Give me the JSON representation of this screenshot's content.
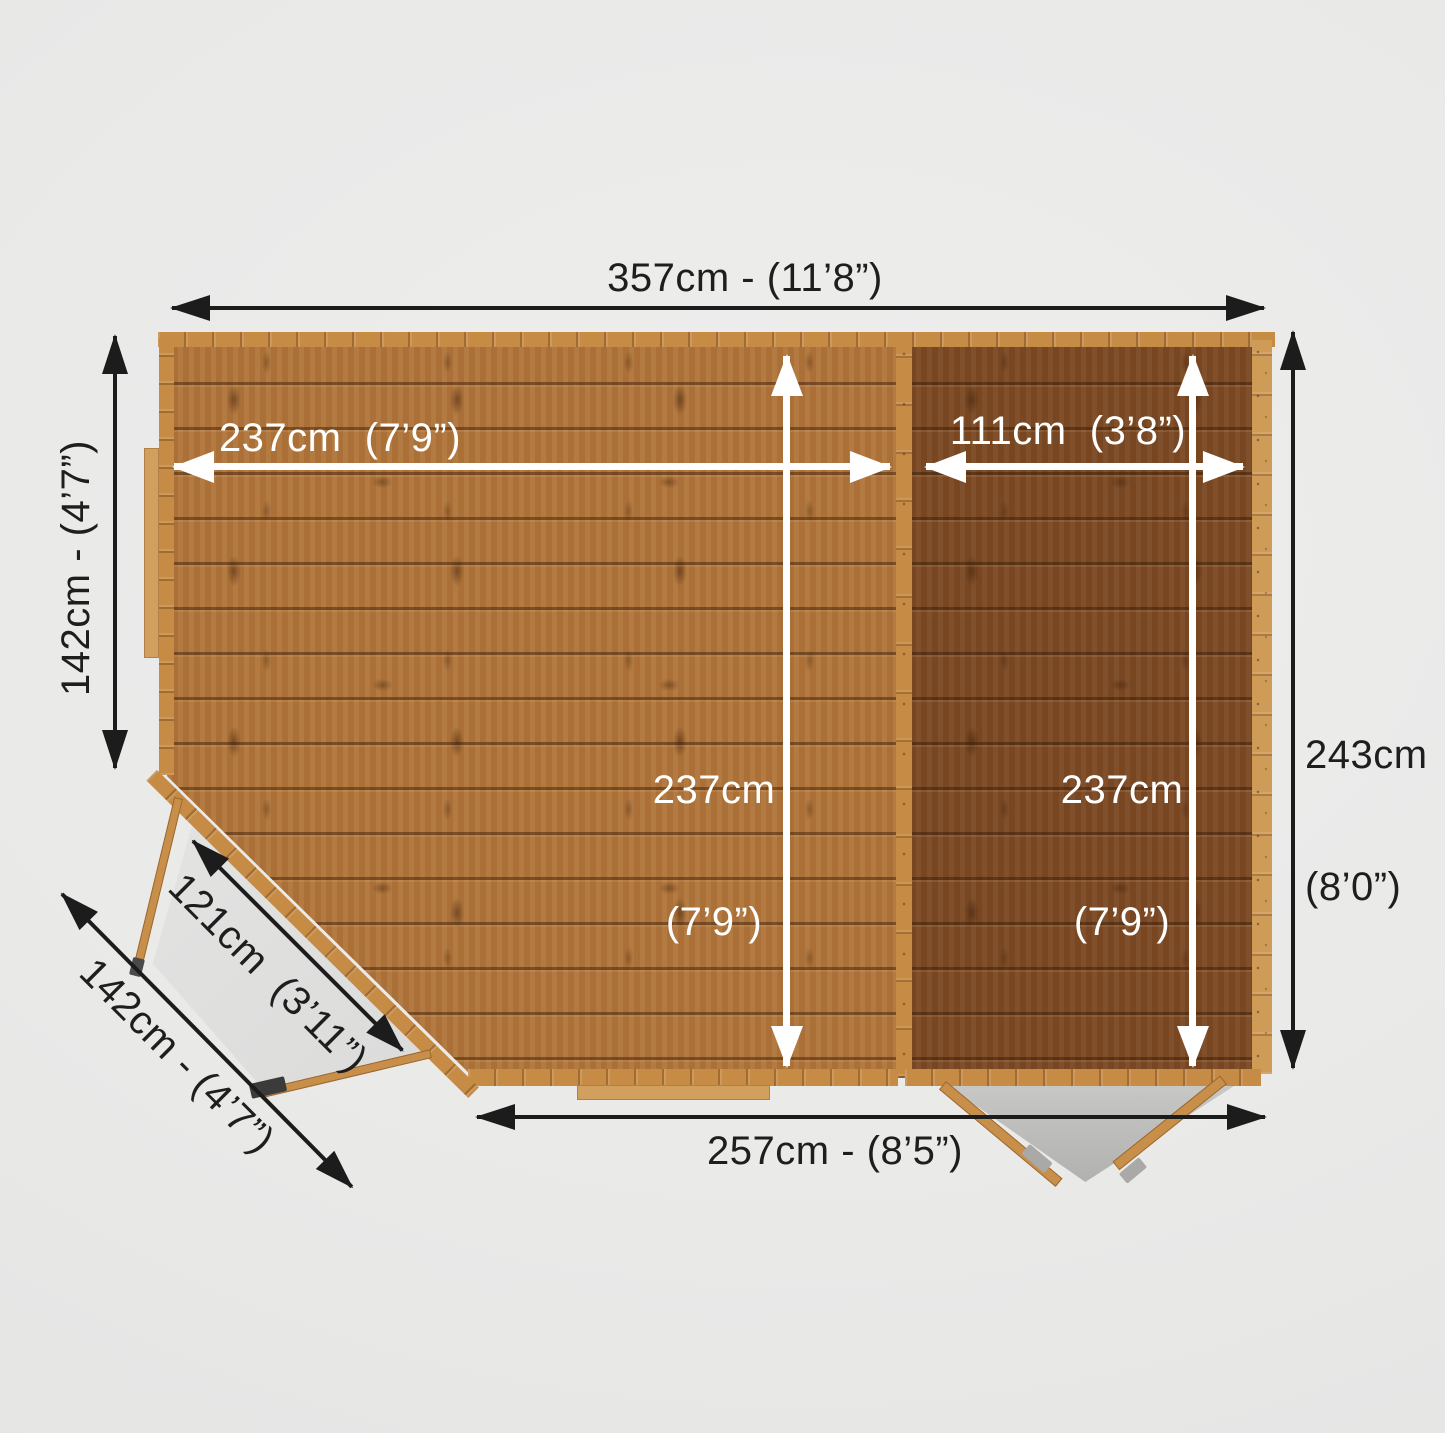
{
  "diagram": {
    "description": "Top-down floor plan of a corner summerhouse with attached side shed, annotated with metric and imperial dimensions",
    "colors": {
      "background": "#eaeae9",
      "dimension_line_dark": "#1c1c1c",
      "dimension_line_light": "#ffffff",
      "floor_main_wood": "#b0743a",
      "floor_side_wood": "#7a4822",
      "wall_wood": "#c68b45",
      "window_wood": "#d2a05e",
      "doorway_shadow": "#bcbcba",
      "label_dark": "#1e1e1e",
      "label_light": "#ffffff"
    }
  },
  "labels": {
    "top_width": "357cm - (11’8”)",
    "left_depth": "142cm - (4’7”)",
    "main_width": "237cm  (7’9”)",
    "right_width": "111cm  (3’8”)",
    "main_depth_cm": "237cm",
    "main_depth_imp": "(7’9”)",
    "right_depth_cm": "237cm",
    "right_depth_imp": "(7’9”)",
    "overall_depth_cm": "243cm",
    "overall_depth_imp": "(8’0”)",
    "bottom_width": "257cm - (8’5”)",
    "door_diagonal": "121cm  (3’11”)",
    "corner_diagonal": "142cm - (4’7”)"
  }
}
